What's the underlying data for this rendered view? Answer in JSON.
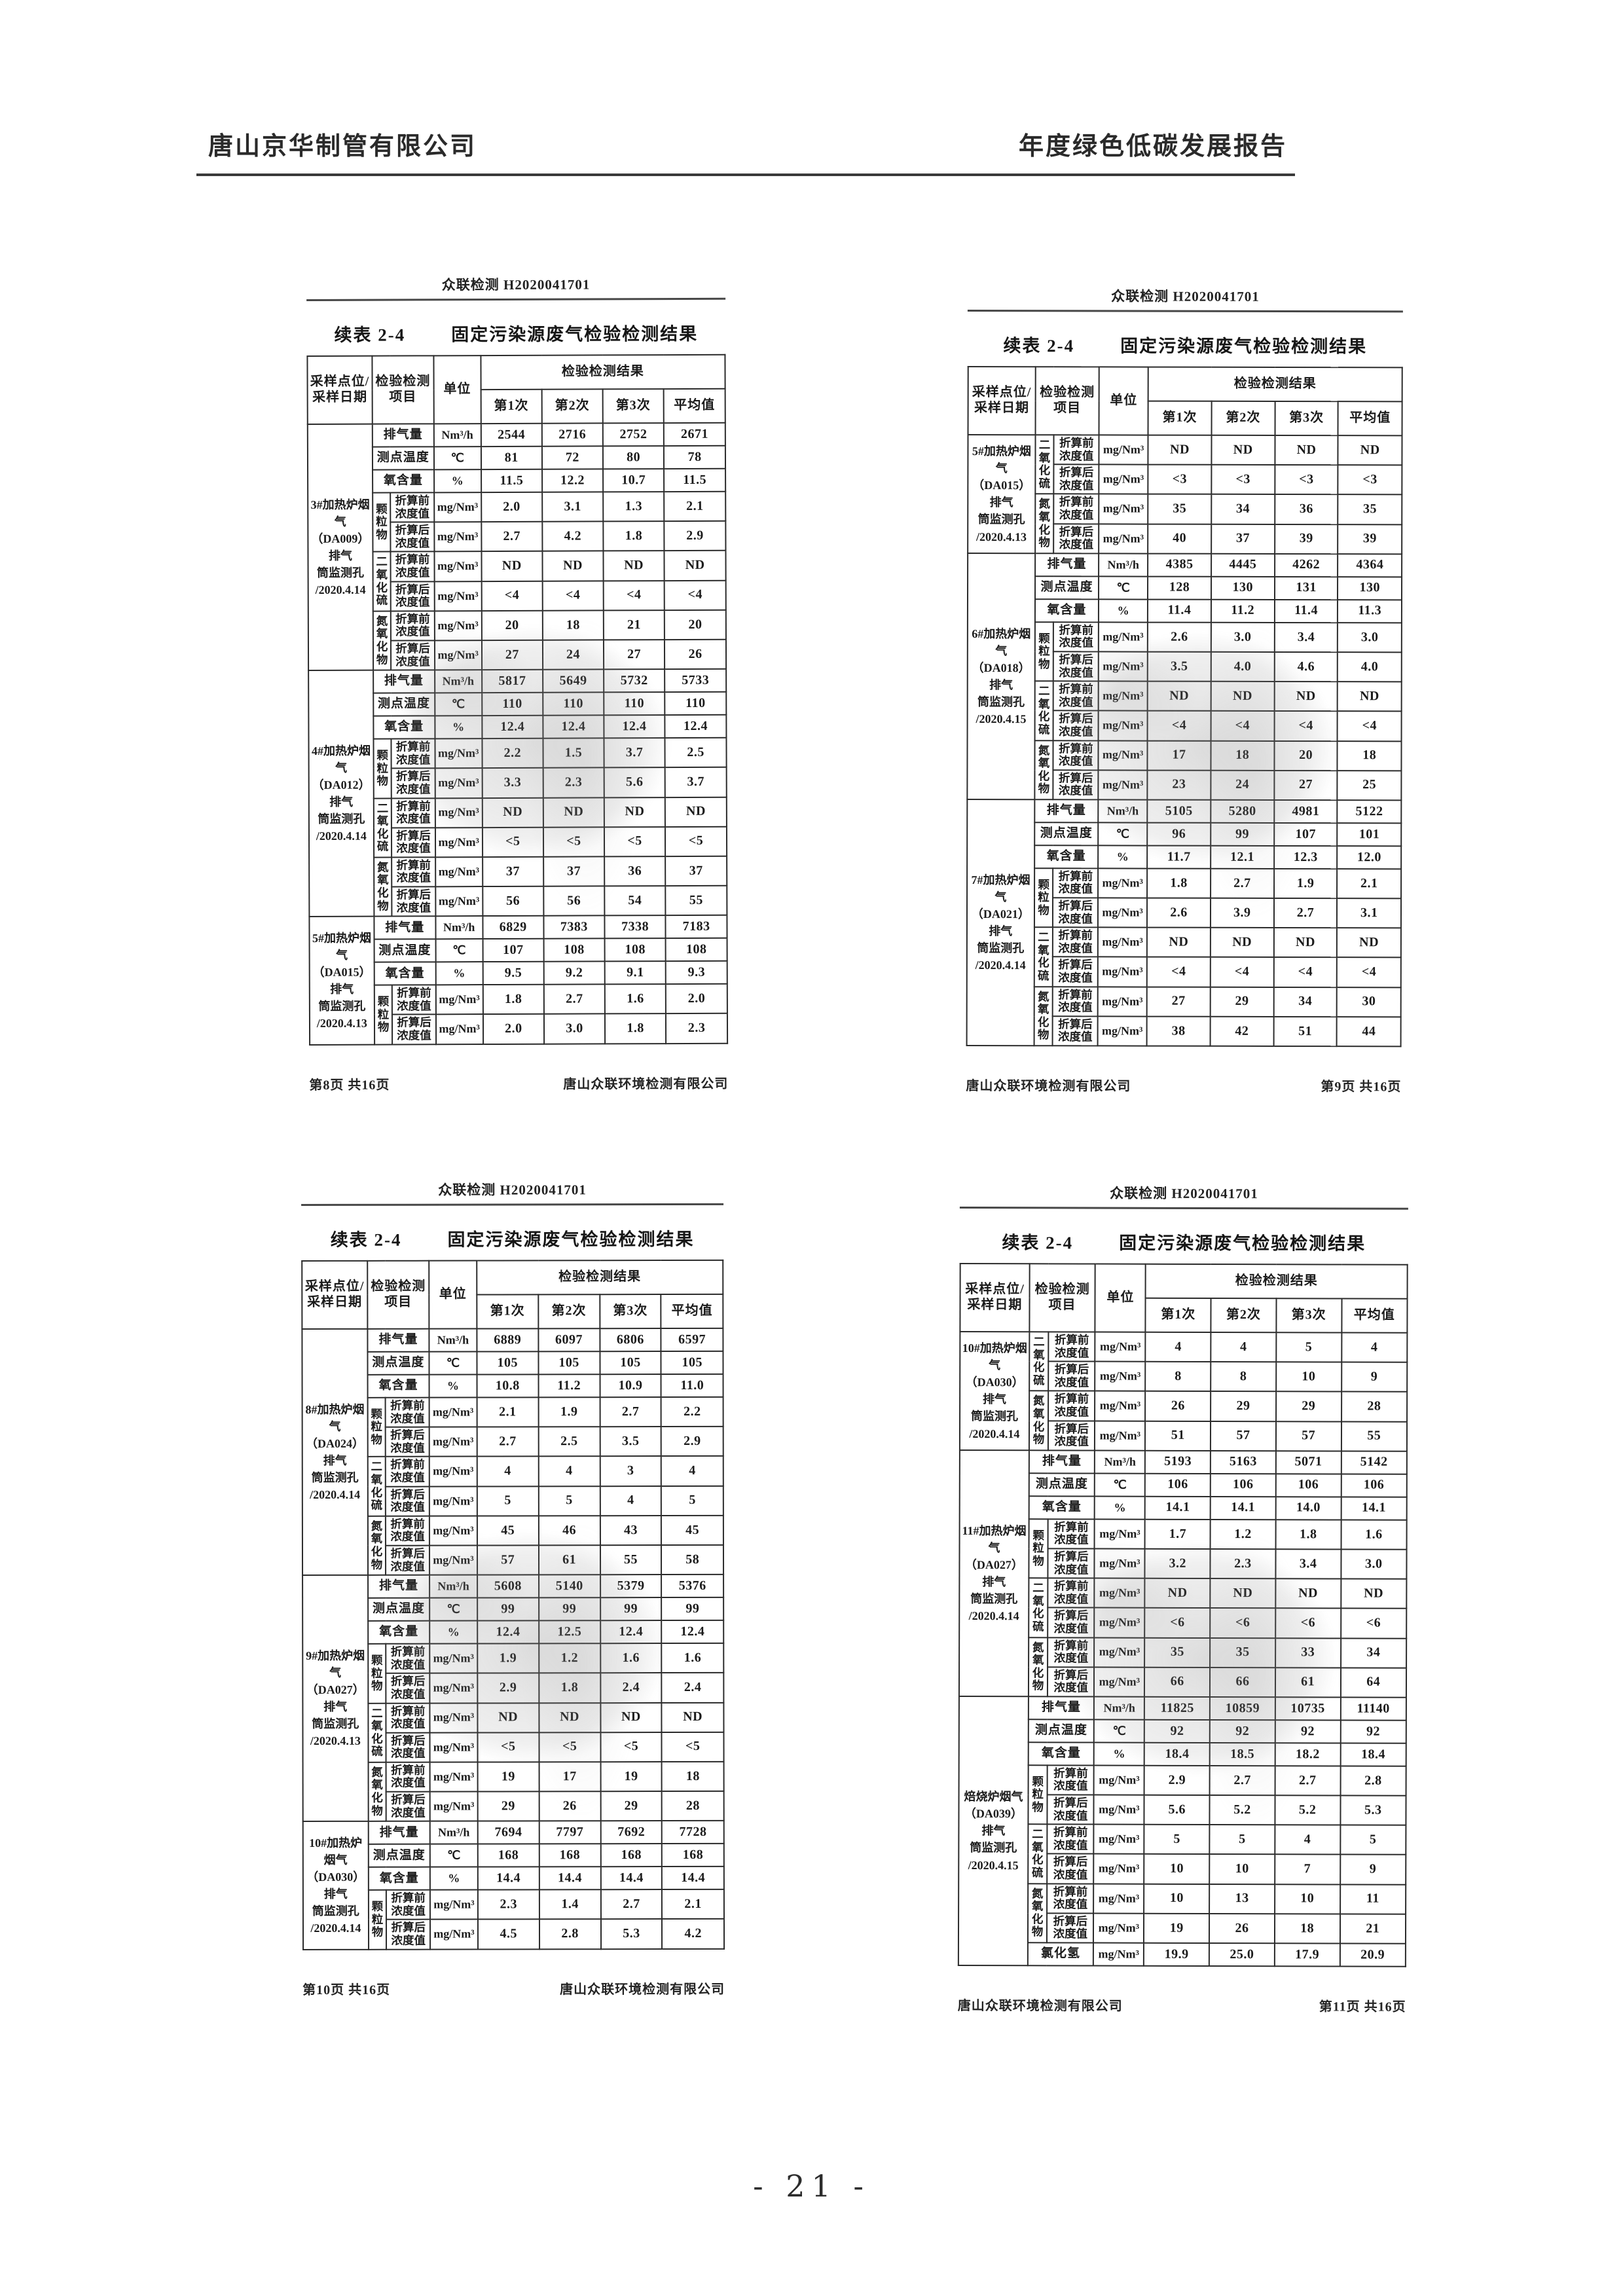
{
  "page": {
    "header_left": "唐山京华制管有限公司",
    "header_right": "年度绿色低碳发展报告",
    "page_number": "- 21 -"
  },
  "shared": {
    "doc_ref": "众联检测 H2020041701",
    "table_label": "续表 2-4",
    "table_title": "固定污染源废气检验检测结果",
    "company": "唐山众联环境检测有限公司",
    "headers": {
      "point": "采样点位/\n采样日期",
      "item": "检验检测\n项目",
      "unit": "单位",
      "result": "检验检测结果",
      "runs": [
        "第1次",
        "第2次",
        "第3次",
        "平均值"
      ]
    }
  },
  "tables": [
    {
      "footer_left": "第8页 共16页",
      "footer_right": "唐山众联环境检测有限公司",
      "sections": [
        {
          "point": "3#加热炉烟气\n（DA009）排气\n筒监测孔\n/2020.4.14",
          "rows": [
            [
              "",
              "排气量",
              "Nm³/h",
              "2544",
              "2716",
              "2752",
              "2671"
            ],
            [
              "",
              "测点温度",
              "℃",
              "81",
              "72",
              "80",
              "78"
            ],
            [
              "",
              "氧含量",
              "%",
              "11.5",
              "12.2",
              "10.7",
              "11.5"
            ],
            [
              "颗粒物",
              "折算前\n浓度值",
              "mg/Nm³",
              "2.0",
              "3.1",
              "1.3",
              "2.1"
            ],
            [
              "+",
              "折算后\n浓度值",
              "mg/Nm³",
              "2.7",
              "4.2",
              "1.8",
              "2.9"
            ],
            [
              "二氧化硫",
              "折算前\n浓度值",
              "mg/Nm³",
              "ND",
              "ND",
              "ND",
              "ND"
            ],
            [
              "+",
              "折算后\n浓度值",
              "mg/Nm³",
              "<4",
              "<4",
              "<4",
              "<4"
            ],
            [
              "氮氧化物",
              "折算前\n浓度值",
              "mg/Nm³",
              "20",
              "18",
              "21",
              "20"
            ],
            [
              "+",
              "折算后\n浓度值",
              "mg/Nm³",
              "27",
              "24",
              "27",
              "26"
            ]
          ]
        },
        {
          "point": "4#加热炉烟气\n（DA012）排气\n筒监测孔\n/2020.4.14",
          "rows": [
            [
              "",
              "排气量",
              "Nm³/h",
              "5817",
              "5649",
              "5732",
              "5733"
            ],
            [
              "",
              "测点温度",
              "℃",
              "110",
              "110",
              "110",
              "110"
            ],
            [
              "",
              "氧含量",
              "%",
              "12.4",
              "12.4",
              "12.4",
              "12.4"
            ],
            [
              "颗粒物",
              "折算前\n浓度值",
              "mg/Nm³",
              "2.2",
              "1.5",
              "3.7",
              "2.5"
            ],
            [
              "+",
              "折算后\n浓度值",
              "mg/Nm³",
              "3.3",
              "2.3",
              "5.6",
              "3.7"
            ],
            [
              "二氧化硫",
              "折算前\n浓度值",
              "mg/Nm³",
              "ND",
              "ND",
              "ND",
              "ND"
            ],
            [
              "+",
              "折算后\n浓度值",
              "mg/Nm³",
              "<5",
              "<5",
              "<5",
              "<5"
            ],
            [
              "氮氧化物",
              "折算前\n浓度值",
              "mg/Nm³",
              "37",
              "37",
              "36",
              "37"
            ],
            [
              "+",
              "折算后\n浓度值",
              "mg/Nm³",
              "56",
              "56",
              "54",
              "55"
            ]
          ]
        },
        {
          "point": "5#加热炉烟气\n（DA015）排气\n筒监测孔\n/2020.4.13",
          "rows": [
            [
              "",
              "排气量",
              "Nm³/h",
              "6829",
              "7383",
              "7338",
              "7183"
            ],
            [
              "",
              "测点温度",
              "℃",
              "107",
              "108",
              "108",
              "108"
            ],
            [
              "",
              "氧含量",
              "%",
              "9.5",
              "9.2",
              "9.1",
              "9.3"
            ],
            [
              "颗粒物",
              "折算前\n浓度值",
              "mg/Nm³",
              "1.8",
              "2.7",
              "1.6",
              "2.0"
            ],
            [
              "+",
              "折算后\n浓度值",
              "mg/Nm³",
              "2.0",
              "3.0",
              "1.8",
              "2.3"
            ]
          ]
        }
      ]
    },
    {
      "footer_left": "唐山众联环境检测有限公司",
      "footer_right": "第9页 共16页",
      "sections": [
        {
          "point": "5#加热炉烟气\n（DA015）排气\n筒监测孔\n/2020.4.13",
          "rows": [
            [
              "二氧化硫",
              "折算前\n浓度值",
              "mg/Nm³",
              "ND",
              "ND",
              "ND",
              "ND"
            ],
            [
              "+",
              "折算后\n浓度值",
              "mg/Nm³",
              "<3",
              "<3",
              "<3",
              "<3"
            ],
            [
              "氮氧化物",
              "折算前\n浓度值",
              "mg/Nm³",
              "35",
              "34",
              "36",
              "35"
            ],
            [
              "+",
              "折算后\n浓度值",
              "mg/Nm³",
              "40",
              "37",
              "39",
              "39"
            ]
          ]
        },
        {
          "point": "6#加热炉烟气\n（DA018）排气\n筒监测孔\n/2020.4.15",
          "rows": [
            [
              "",
              "排气量",
              "Nm³/h",
              "4385",
              "4445",
              "4262",
              "4364"
            ],
            [
              "",
              "测点温度",
              "℃",
              "128",
              "130",
              "131",
              "130"
            ],
            [
              "",
              "氧含量",
              "%",
              "11.4",
              "11.2",
              "11.4",
              "11.3"
            ],
            [
              "颗粒物",
              "折算前\n浓度值",
              "mg/Nm³",
              "2.6",
              "3.0",
              "3.4",
              "3.0"
            ],
            [
              "+",
              "折算后\n浓度值",
              "mg/Nm³",
              "3.5",
              "4.0",
              "4.6",
              "4.0"
            ],
            [
              "二氧化硫",
              "折算前\n浓度值",
              "mg/Nm³",
              "ND",
              "ND",
              "ND",
              "ND"
            ],
            [
              "+",
              "折算后\n浓度值",
              "mg/Nm³",
              "<4",
              "<4",
              "<4",
              "<4"
            ],
            [
              "氮氧化物",
              "折算前\n浓度值",
              "mg/Nm³",
              "17",
              "18",
              "20",
              "18"
            ],
            [
              "+",
              "折算后\n浓度值",
              "mg/Nm³",
              "23",
              "24",
              "27",
              "25"
            ]
          ]
        },
        {
          "point": "7#加热炉烟气\n（DA021）排气\n筒监测孔\n/2020.4.14",
          "rows": [
            [
              "",
              "排气量",
              "Nm³/h",
              "5105",
              "5280",
              "4981",
              "5122"
            ],
            [
              "",
              "测点温度",
              "℃",
              "96",
              "99",
              "107",
              "101"
            ],
            [
              "",
              "氧含量",
              "%",
              "11.7",
              "12.1",
              "12.3",
              "12.0"
            ],
            [
              "颗粒物",
              "折算前\n浓度值",
              "mg/Nm³",
              "1.8",
              "2.7",
              "1.9",
              "2.1"
            ],
            [
              "+",
              "折算后\n浓度值",
              "mg/Nm³",
              "2.6",
              "3.9",
              "2.7",
              "3.1"
            ],
            [
              "二氧化硫",
              "折算前\n浓度值",
              "mg/Nm³",
              "ND",
              "ND",
              "ND",
              "ND"
            ],
            [
              "+",
              "折算后\n浓度值",
              "mg/Nm³",
              "<4",
              "<4",
              "<4",
              "<4"
            ],
            [
              "氮氧化物",
              "折算前\n浓度值",
              "mg/Nm³",
              "27",
              "29",
              "34",
              "30"
            ],
            [
              "+",
              "折算后\n浓度值",
              "mg/Nm³",
              "38",
              "42",
              "51",
              "44"
            ]
          ]
        }
      ]
    },
    {
      "footer_left": "第10页 共16页",
      "footer_right": "唐山众联环境检测有限公司",
      "sections": [
        {
          "point": "8#加热炉烟气\n（DA024）排气\n筒监测孔\n/2020.4.14",
          "rows": [
            [
              "",
              "排气量",
              "Nm³/h",
              "6889",
              "6097",
              "6806",
              "6597"
            ],
            [
              "",
              "测点温度",
              "℃",
              "105",
              "105",
              "105",
              "105"
            ],
            [
              "",
              "氧含量",
              "%",
              "10.8",
              "11.2",
              "10.9",
              "11.0"
            ],
            [
              "颗粒物",
              "折算前\n浓度值",
              "mg/Nm³",
              "2.1",
              "1.9",
              "2.7",
              "2.2"
            ],
            [
              "+",
              "折算后\n浓度值",
              "mg/Nm³",
              "2.7",
              "2.5",
              "3.5",
              "2.9"
            ],
            [
              "二氧化硫",
              "折算前\n浓度值",
              "mg/Nm³",
              "4",
              "4",
              "3",
              "4"
            ],
            [
              "+",
              "折算后\n浓度值",
              "mg/Nm³",
              "5",
              "5",
              "4",
              "5"
            ],
            [
              "氮氧化物",
              "折算前\n浓度值",
              "mg/Nm³",
              "45",
              "46",
              "43",
              "45"
            ],
            [
              "+",
              "折算后\n浓度值",
              "mg/Nm³",
              "57",
              "61",
              "55",
              "58"
            ]
          ]
        },
        {
          "point": "9#加热炉烟气\n（DA027）排气\n筒监测孔\n/2020.4.13",
          "rows": [
            [
              "",
              "排气量",
              "Nm³/h",
              "5608",
              "5140",
              "5379",
              "5376"
            ],
            [
              "",
              "测点温度",
              "℃",
              "99",
              "99",
              "99",
              "99"
            ],
            [
              "",
              "氧含量",
              "%",
              "12.4",
              "12.5",
              "12.4",
              "12.4"
            ],
            [
              "颗粒物",
              "折算前\n浓度值",
              "mg/Nm³",
              "1.9",
              "1.2",
              "1.6",
              "1.6"
            ],
            [
              "+",
              "折算后\n浓度值",
              "mg/Nm³",
              "2.9",
              "1.8",
              "2.4",
              "2.4"
            ],
            [
              "二氧化硫",
              "折算前\n浓度值",
              "mg/Nm³",
              "ND",
              "ND",
              "ND",
              "ND"
            ],
            [
              "+",
              "折算后\n浓度值",
              "mg/Nm³",
              "<5",
              "<5",
              "<5",
              "<5"
            ],
            [
              "氮氧化物",
              "折算前\n浓度值",
              "mg/Nm³",
              "19",
              "17",
              "19",
              "18"
            ],
            [
              "+",
              "折算后\n浓度值",
              "mg/Nm³",
              "29",
              "26",
              "29",
              "28"
            ]
          ]
        },
        {
          "point": "10#加热炉烟气\n（DA030）排气\n筒监测孔\n/2020.4.14",
          "rows": [
            [
              "",
              "排气量",
              "Nm³/h",
              "7694",
              "7797",
              "7692",
              "7728"
            ],
            [
              "",
              "测点温度",
              "℃",
              "168",
              "168",
              "168",
              "168"
            ],
            [
              "",
              "氧含量",
              "%",
              "14.4",
              "14.4",
              "14.4",
              "14.4"
            ],
            [
              "颗粒物",
              "折算前\n浓度值",
              "mg/Nm³",
              "2.3",
              "1.4",
              "2.7",
              "2.1"
            ],
            [
              "+",
              "折算后\n浓度值",
              "mg/Nm³",
              "4.5",
              "2.8",
              "5.3",
              "4.2"
            ]
          ]
        }
      ]
    },
    {
      "footer_left": "唐山众联环境检测有限公司",
      "footer_right": "第11页 共16页",
      "sections": [
        {
          "point": "10#加热炉烟气\n（DA030）排气\n筒监测孔\n/2020.4.14",
          "rows": [
            [
              "二氧化硫",
              "折算前\n浓度值",
              "mg/Nm³",
              "4",
              "4",
              "5",
              "4"
            ],
            [
              "+",
              "折算后\n浓度值",
              "mg/Nm³",
              "8",
              "8",
              "10",
              "9"
            ],
            [
              "氮氧化物",
              "折算前\n浓度值",
              "mg/Nm³",
              "26",
              "29",
              "29",
              "28"
            ],
            [
              "+",
              "折算后\n浓度值",
              "mg/Nm³",
              "51",
              "57",
              "57",
              "55"
            ]
          ]
        },
        {
          "point": "11#加热炉烟气\n（DA027）排气\n筒监测孔\n/2020.4.14",
          "rows": [
            [
              "",
              "排气量",
              "Nm³/h",
              "5193",
              "5163",
              "5071",
              "5142"
            ],
            [
              "",
              "测点温度",
              "℃",
              "106",
              "106",
              "106",
              "106"
            ],
            [
              "",
              "氧含量",
              "%",
              "14.1",
              "14.1",
              "14.0",
              "14.1"
            ],
            [
              "颗粒物",
              "折算前\n浓度值",
              "mg/Nm³",
              "1.7",
              "1.2",
              "1.8",
              "1.6"
            ],
            [
              "+",
              "折算后\n浓度值",
              "mg/Nm³",
              "3.2",
              "2.3",
              "3.4",
              "3.0"
            ],
            [
              "二氧化硫",
              "折算前\n浓度值",
              "mg/Nm³",
              "ND",
              "ND",
              "ND",
              "ND"
            ],
            [
              "+",
              "折算后\n浓度值",
              "mg/Nm³",
              "<6",
              "<6",
              "<6",
              "<6"
            ],
            [
              "氮氧化物",
              "折算前\n浓度值",
              "mg/Nm³",
              "35",
              "35",
              "33",
              "34"
            ],
            [
              "+",
              "折算后\n浓度值",
              "mg/Nm³",
              "66",
              "66",
              "61",
              "64"
            ]
          ]
        },
        {
          "point": "焙烧炉烟气\n（DA039）排气\n筒监测孔\n/2020.4.15",
          "rows": [
            [
              "",
              "排气量",
              "Nm³/h",
              "11825",
              "10859",
              "10735",
              "11140"
            ],
            [
              "",
              "测点温度",
              "℃",
              "92",
              "92",
              "92",
              "92"
            ],
            [
              "",
              "氧含量",
              "%",
              "18.4",
              "18.5",
              "18.2",
              "18.4"
            ],
            [
              "颗粒物",
              "折算前\n浓度值",
              "mg/Nm³",
              "2.9",
              "2.7",
              "2.7",
              "2.8"
            ],
            [
              "+",
              "折算后\n浓度值",
              "mg/Nm³",
              "5.6",
              "5.2",
              "5.2",
              "5.3"
            ],
            [
              "二氧化硫",
              "折算前\n浓度值",
              "mg/Nm³",
              "5",
              "5",
              "4",
              "5"
            ],
            [
              "+",
              "折算后\n浓度值",
              "mg/Nm³",
              "10",
              "10",
              "7",
              "9"
            ],
            [
              "氮氧化物",
              "折算前\n浓度值",
              "mg/Nm³",
              "10",
              "13",
              "10",
              "11"
            ],
            [
              "+",
              "折算后\n浓度值",
              "mg/Nm³",
              "19",
              "26",
              "18",
              "21"
            ],
            [
              "",
              "氯化氢",
              "mg/Nm³",
              "19.9",
              "25.0",
              "17.9",
              "20.9"
            ]
          ]
        }
      ]
    }
  ]
}
